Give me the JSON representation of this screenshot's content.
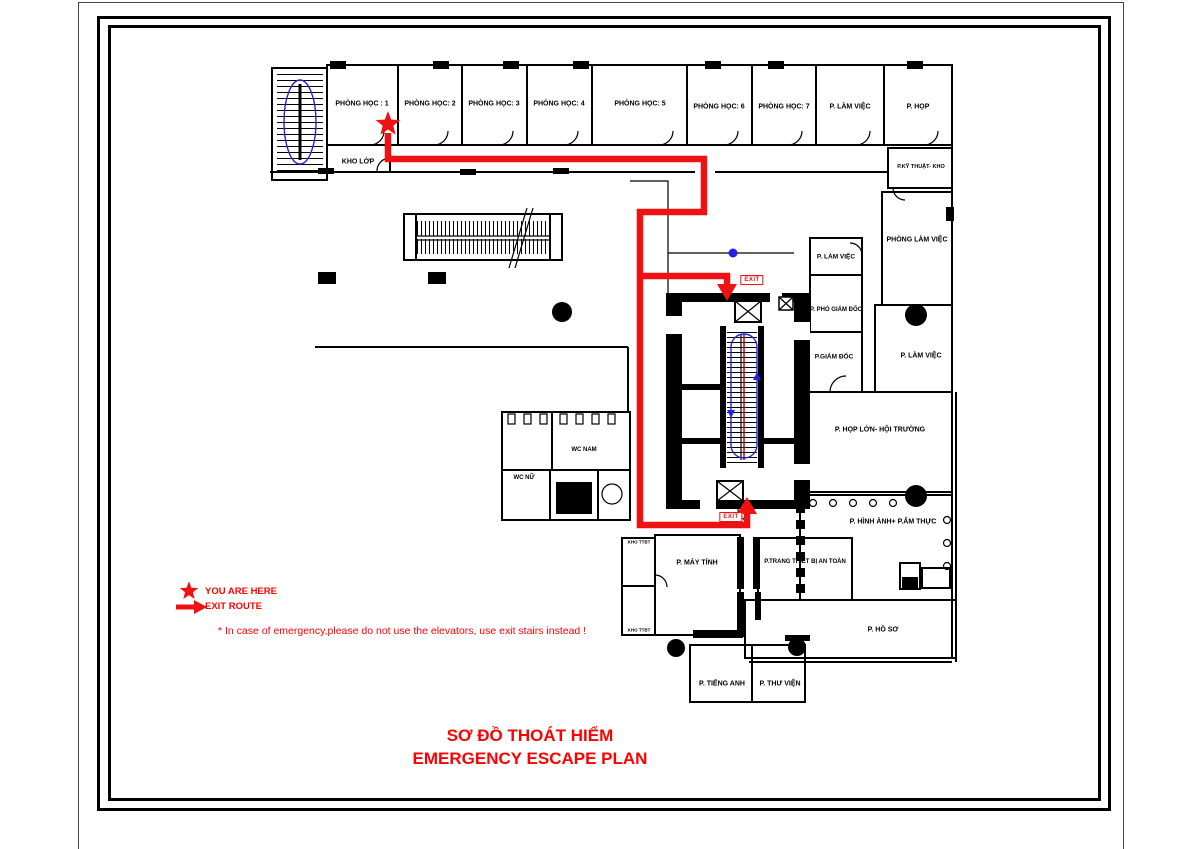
{
  "page": {
    "title_line1": "SƠ ĐỒ THOÁT HIỂM",
    "title_line2": "EMERGENCY ESCAPE PLAN"
  },
  "legend": {
    "you_are_here": "YOU ARE HERE",
    "exit_route": "EXIT ROUTE",
    "note": "* In case of emergency,please do not use the elevators, use exit stairs instead !"
  },
  "colors": {
    "route_red": "#ee1212",
    "text_red": "#ff0000",
    "stair_blue": "#2323dd"
  },
  "exit_signs": [
    {
      "id": "exit-upper",
      "label": "EXIT",
      "x": 752,
      "y": 280
    },
    {
      "id": "exit-lower",
      "label": "EXIT",
      "x": 731,
      "y": 517
    }
  ],
  "rooms": [
    {
      "id": "phong-hoc-1",
      "label": "PHÒNG HỌC : 1",
      "x": 362,
      "y": 104,
      "fs": 7
    },
    {
      "id": "phong-hoc-2",
      "label": "PHÒNG HỌC: 2",
      "x": 430,
      "y": 104,
      "fs": 7
    },
    {
      "id": "phong-hoc-3",
      "label": "PHÒNG HỌC: 3",
      "x": 494,
      "y": 104,
      "fs": 7
    },
    {
      "id": "phong-hoc-4",
      "label": "PHÒNG HỌC: 4",
      "x": 559,
      "y": 104,
      "fs": 7
    },
    {
      "id": "phong-hoc-5",
      "label": "PHÒNG HỌC: 5",
      "x": 640,
      "y": 104,
      "fs": 7
    },
    {
      "id": "phong-hoc-6",
      "label": "PHÒNG HỌC: 6",
      "x": 719,
      "y": 107,
      "fs": 7
    },
    {
      "id": "phong-hoc-7",
      "label": "PHÒNG HỌC: 7",
      "x": 784,
      "y": 107,
      "fs": 7
    },
    {
      "id": "lam-viec-top",
      "label": "P. LÀM VIỆC",
      "x": 850,
      "y": 107,
      "fs": 7
    },
    {
      "id": "hop",
      "label": "P. HỌP",
      "x": 918,
      "y": 107,
      "fs": 7
    },
    {
      "id": "kho-lop",
      "label": "KHO LỚP",
      "x": 358,
      "y": 162,
      "fs": 7
    },
    {
      "id": "ky-thuat-kho",
      "label": "P.KỸ THUẬT- KHO",
      "x": 921,
      "y": 167,
      "fs": 5.5
    },
    {
      "id": "phong-lam-viec",
      "label": "PHÒNG LÀM VIỆC",
      "x": 917,
      "y": 240,
      "fs": 7
    },
    {
      "id": "lam-viec-mid",
      "label": "P. LÀM VIỆC",
      "x": 836,
      "y": 257,
      "fs": 6.5
    },
    {
      "id": "pho-giam-doc",
      "label": "P. PHÓ GIÁM ĐỐC",
      "x": 836,
      "y": 310,
      "fs": 6
    },
    {
      "id": "giam-doc",
      "label": "P.GIÁM ĐỐC",
      "x": 834,
      "y": 357,
      "fs": 6.5
    },
    {
      "id": "lam-viec-right",
      "label": "P. LÀM VIỆC",
      "x": 921,
      "y": 356,
      "fs": 7
    },
    {
      "id": "hop-lon-hoi-truong",
      "label": "P. HỌP LỚN- HỘI TRƯỜNG",
      "x": 880,
      "y": 430,
      "fs": 7
    },
    {
      "id": "hinh-anh-am-thuc",
      "label": "P. HÌNH ẢNH+ P.ẨM THỰC",
      "x": 893,
      "y": 522,
      "fs": 7
    },
    {
      "id": "wc-nam",
      "label": "WC NAM",
      "x": 584,
      "y": 450,
      "fs": 6
    },
    {
      "id": "wc-nu",
      "label": "WC NỮ",
      "x": 524,
      "y": 478,
      "fs": 6
    },
    {
      "id": "kho-ttbt-tren",
      "label": "KHO TTBT",
      "x": 639,
      "y": 542,
      "fs": 4.5
    },
    {
      "id": "kho-ttbt-duoi",
      "label": "KHO TTBT",
      "x": 639,
      "y": 630,
      "fs": 4.5
    },
    {
      "id": "may-tinh",
      "label": "P. MÁY TÍNH",
      "x": 697,
      "y": 563,
      "fs": 7
    },
    {
      "id": "trang-thiet-bi-an-toan",
      "label": "P.TRANG THIẾT BỊ AN TOÀN",
      "x": 805,
      "y": 562,
      "fs": 6
    },
    {
      "id": "ho-so",
      "label": "P. HỒ SƠ",
      "x": 883,
      "y": 630,
      "fs": 7
    },
    {
      "id": "tieng-anh",
      "label": "P. TIẾNG ANH",
      "x": 722,
      "y": 684,
      "fs": 7
    },
    {
      "id": "thu-vien",
      "label": "P. THƯ VIỆN",
      "x": 780,
      "y": 684,
      "fs": 7
    }
  ]
}
